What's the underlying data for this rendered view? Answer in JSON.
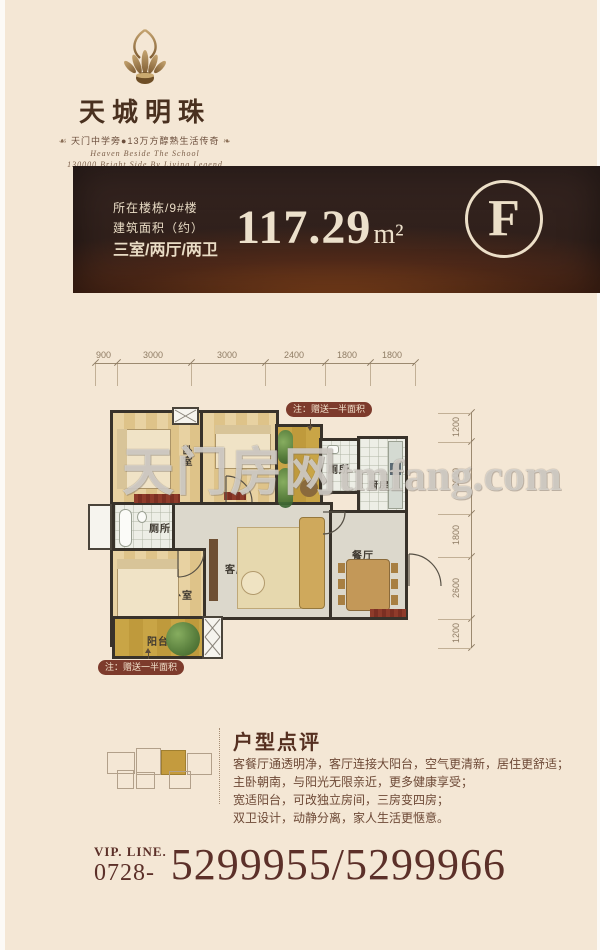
{
  "header": {
    "logo_name": "天城明珠",
    "flourish_left": "☙",
    "flourish_right": "❧",
    "tagline": "天门中学旁●13万方醇熟生活传奇",
    "script_line1": "Heaven Beside The School",
    "script_line2": "130000 Bright Side By Living Legend",
    "ornament": "❦❦"
  },
  "banner": {
    "building_line": "所在楼栋/9#楼",
    "area_label_line": "建筑面积（约）",
    "layout_line": "三室/两厅/两卫",
    "area_value": "117.29",
    "area_unit": "m²",
    "unit_letter": "F",
    "bg_color": "#2f1f1b",
    "glow_color": "#ba5e20",
    "text_color": "#ece0cb"
  },
  "floorplan": {
    "dims_top": [
      "900",
      "3000",
      "3000",
      "2400",
      "1800",
      "1800"
    ],
    "dims_right": [
      "1200",
      "3000",
      "1800",
      "2600",
      "1200"
    ],
    "rooms": [
      {
        "name": "bedroom-top-left",
        "label": "卧室"
      },
      {
        "name": "bedroom-top-mid",
        "label": "卧室"
      },
      {
        "name": "bathroom-top",
        "label": "厕所"
      },
      {
        "name": "kitchen",
        "label": "厨房"
      },
      {
        "name": "bathroom-left",
        "label": "厕所"
      },
      {
        "name": "master-bedroom",
        "label": "卧室"
      },
      {
        "name": "living-room",
        "label": "客厅"
      },
      {
        "name": "dining-room",
        "label": "餐厅"
      },
      {
        "name": "balcony",
        "label": "阳台"
      }
    ],
    "gift_note_top": "注：赠送一半面积",
    "gift_note_bottom": "注：赠送一半面积",
    "watermark_cjk": "天门房网",
    "watermark_latin": "tmfang.com"
  },
  "review": {
    "title": "户型点评",
    "lines": [
      "客餐厅通透明净，客厅连接大阳台，空气更清新，居住更舒适；",
      "主卧朝南，与阳光无限亲近，更多健康享受；",
      "宽适阳台，可改独立房间，三房变四房；",
      "双卫设计，动静分离，家人生活更惬意。"
    ]
  },
  "contact": {
    "vip_label": "VIP. LINE.",
    "area_code": "0728-",
    "phone_numbers": "5299955/5299966"
  }
}
